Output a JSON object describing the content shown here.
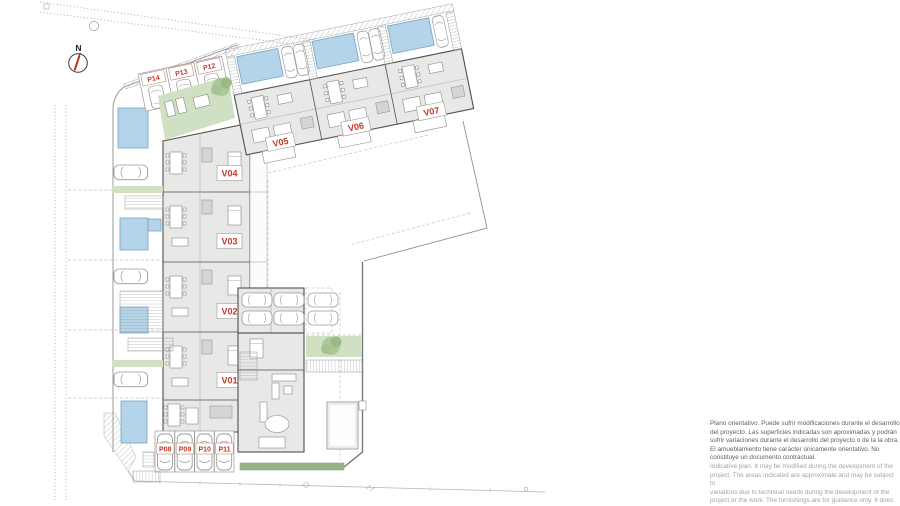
{
  "plan": {
    "compass_label": "N",
    "labels": {
      "v01": "V01",
      "v02": "V02",
      "v03": "V03",
      "v04": "V04",
      "v05": "V05",
      "v06": "V06",
      "v07": "V07",
      "p08": "P08",
      "p09": "P09",
      "p10": "P10",
      "p11": "P11",
      "p12": "P12",
      "p13": "P13",
      "p14": "P14"
    },
    "colors": {
      "label_red": "#c0392b",
      "pool_blue": "#b3d4e9",
      "lawn_green": "#cfe0c3",
      "hedge_green": "#96b584",
      "wall_gray": "#4f4f4f"
    }
  },
  "disclaimer": {
    "es": [
      "Plano orientativo. Puede sufrir modificaciones durante el desarrollo",
      "del proyecto. Las superficies indicadas son aproximadas y podrán",
      "sufrir variaciones durante el desarrollo del proyecto o de la la obra.",
      "El amueblamiento tiene carácter únicamente orientativo. No",
      "constituye un documento contractual."
    ],
    "en": [
      "Indicative plan. It may be modified during the development of the",
      "project. The areas indicated are approximate and may be subject to",
      "variations due to technical needs during the development of the",
      "project or the work. The furnishings are for guidance only. It does"
    ]
  }
}
